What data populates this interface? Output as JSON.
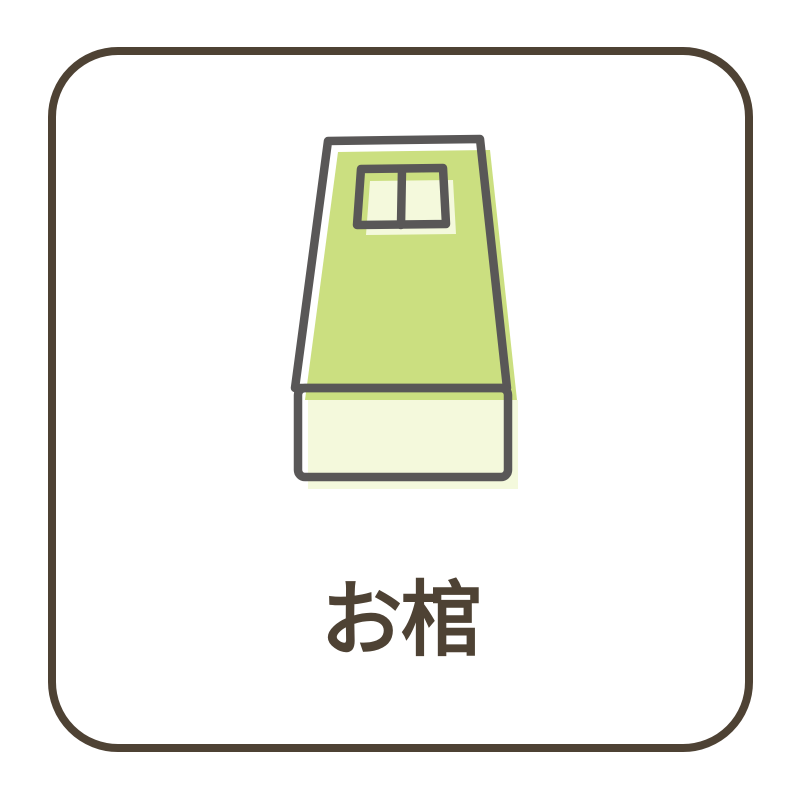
{
  "card": {
    "label": "お棺",
    "illustration": "coffin-icon"
  },
  "colors": {
    "background": "#ffffff",
    "frame_border": "#4e4234",
    "label_text": "#4e4234",
    "illustration_outline": "#595757",
    "coffin_lid_green": "#cbdf80",
    "coffin_pale": "#f4f9dc"
  }
}
